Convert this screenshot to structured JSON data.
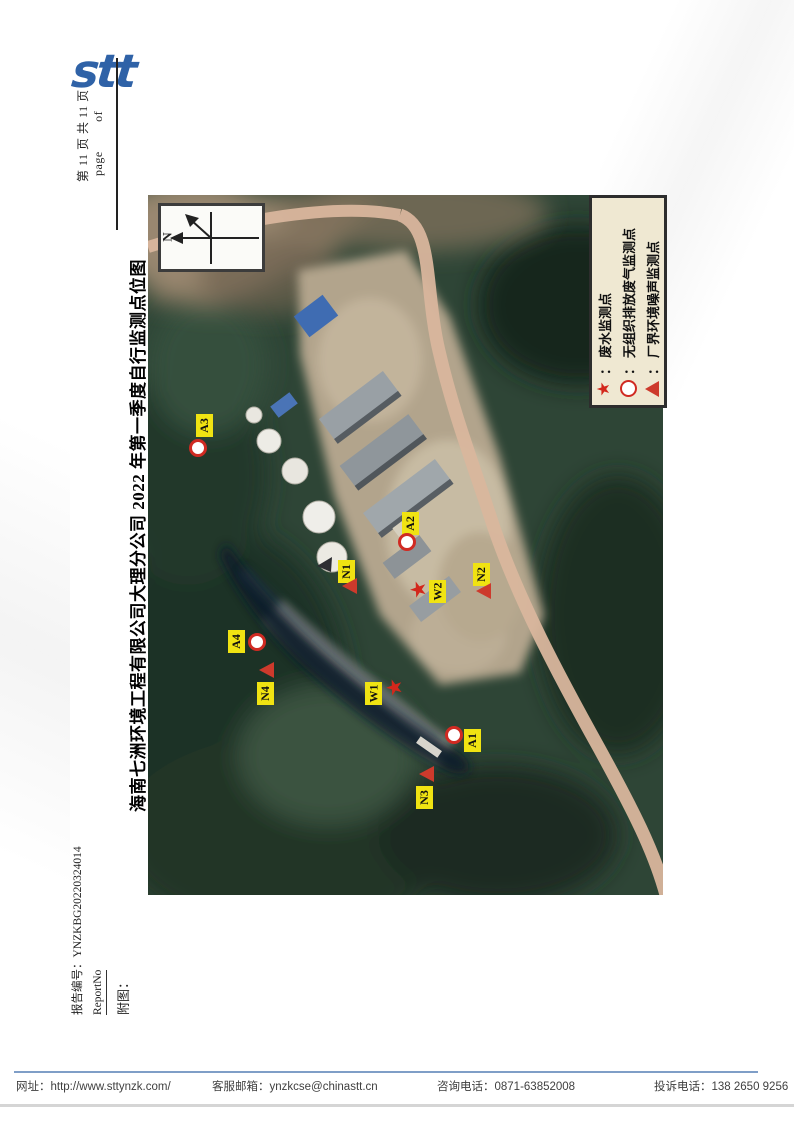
{
  "logo": {
    "text": "stt"
  },
  "page_header": {
    "page_info_cn": "第 11 页 共 11 页",
    "page_word": "page",
    "of_word": "of"
  },
  "title": "海南七洲环境工程有限公司大理分公司 2022 年第一季度自行监测点位图",
  "map": {
    "compass_label": "N",
    "legend": {
      "items": [
        {
          "icon": "star-icon",
          "separator": "：",
          "label": "废水监测点"
        },
        {
          "icon": "circle-icon",
          "separator": "：",
          "label": "无组织排放废气监测点"
        },
        {
          "icon": "triangle-icon",
          "separator": "：",
          "label": "厂界环境噪声监测点"
        }
      ]
    },
    "markers": [
      {
        "label": "A3",
        "type": "circle"
      },
      {
        "label": "A2",
        "type": "circle"
      },
      {
        "label": "N1",
        "type": "triangle"
      },
      {
        "label": "W2",
        "type": "star"
      },
      {
        "label": "N2",
        "type": "triangle"
      },
      {
        "label": "A4",
        "type": "circle"
      },
      {
        "label": "N4",
        "type": "triangle"
      },
      {
        "label": "W1",
        "type": "star"
      },
      {
        "label": "A1",
        "type": "circle"
      },
      {
        "label": "N3",
        "type": "triangle"
      }
    ]
  },
  "icons": {
    "star_glyph": "★"
  },
  "report_info": {
    "report_no_label": "报告编号：",
    "report_no_value": "YNZKBG20220324014",
    "report_no_en": "ReportNo",
    "attachment_label": "附图："
  },
  "footer": {
    "website_label": "网址：",
    "website_value": "http://www.sttynzk.com/",
    "email_label": "客服邮箱：",
    "email_value": "ynzkcse@chinastt.cn",
    "phone_label": "咨询电话：",
    "phone_value": "0871-63852008",
    "complaint_label": "投诉电话：",
    "complaint_value": "138 2650 9256"
  },
  "colors": {
    "logo_blue": "#2f62a7",
    "marker_yellow": "#f0e312",
    "marker_red": "#cd3a2c",
    "legend_bg": "#efe8d2",
    "footer_line_blue": "#7f9ec7"
  }
}
